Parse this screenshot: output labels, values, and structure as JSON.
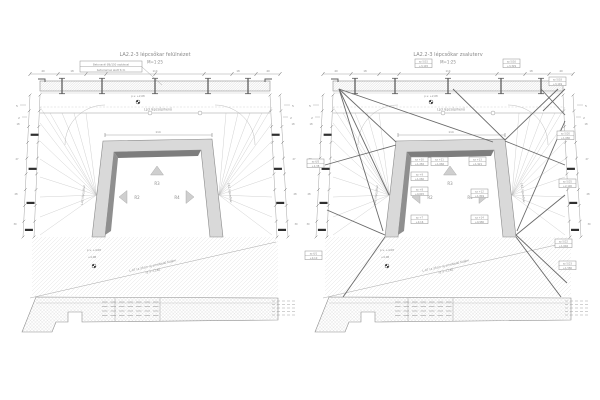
{
  "colors": {
    "background": "#ffffff",
    "line": "#9b9b9b",
    "thin_line": "#bdbdbd",
    "dark_line": "#5e5e5e",
    "text": "#8a8a8a",
    "frame_fill": "#d9d9d9",
    "frame_shadow": "#7d7d7d",
    "arrow_fill": "#cfcfcf",
    "hatch": "#d6d6d6",
    "tie_bar": "#2f2f2f"
  },
  "panels": [
    {
      "title": "LA2.2-3 lépcsőkar felülnézet",
      "scale": "M=1:25",
      "note_line1": "Betonacél Ø6/150 osztással",
      "note_line2": "betonlemez alatt 5cm",
      "landing_label": "Lp3 lépcsőpihenő",
      "benchmark_top": "p.v. +2,08",
      "benchmark_left_line1": "p.v. +4,08",
      "benchmark_left_line2": "+4,08",
      "slab_note_line1": "L-07 (a 25cm-ig emelkedő födém",
      "slab_note_line2": "sz = +2,80",
      "arrow_up_label": "R3",
      "arrow_left_label": "R2",
      "arrow_right_label": "R4",
      "side_label_left": "LA2 lépcsőkar",
      "side_label_right": "LA2 lépcsőkar",
      "top_dims": [
        "40",
        "18",
        "114",
        "18",
        "40"
      ],
      "frame_dim": "114",
      "side_dims": [
        "18",
        "27",
        "28",
        "30"
      ],
      "tick_labels": [
        "5",
        "2"
      ]
    },
    {
      "title": "LA2.2-3 lépcsőkar zsaluterv",
      "scale": "M=1:25",
      "landing_label": "Lp3 lépcsőpihenő",
      "benchmark_top": "p.v. +2,08",
      "benchmark_left_line1": "p.v. +4,08",
      "benchmark_left_line2": "+4,08",
      "slab_note_line1": "L-07 (a 25cm-ig emelkedő födém",
      "slab_note_line2": "sz = +2,80",
      "arrow_up_label": "R3",
      "arrow_left_label": "R2",
      "arrow_right_label": "R4",
      "side_label_left": "LA2 lépcsőkar",
      "side_label_right": "LA2 lépcsőkar",
      "top_dims": [
        "40",
        "18",
        "114",
        "18",
        "40"
      ],
      "frame_dim": "114",
      "side_dims": [
        "18",
        "27",
        "28",
        "30"
      ],
      "tick_labels": [
        "5",
        "2"
      ],
      "tags": [
        {
          "l1": "sz 5/15",
          "l2": "+3,145"
        },
        {
          "l1": "sz 5/16",
          "l2": "+3,329"
        },
        {
          "l1": "sz 5/18",
          "l2": "+3,149"
        },
        {
          "l1": "sz 5/20",
          "l2": "+1,680"
        },
        {
          "l1": "sz 5/25",
          "l2": "+2,190"
        },
        {
          "l1": "sz 5/22",
          "l2": "+1,646"
        },
        {
          "l1": "sz 5/23",
          "l2": "+1,580"
        },
        {
          "l1": "sz 6/5",
          "l2": "+1,38"
        },
        {
          "l1": "sz 6/1",
          "l2": "+0,10"
        },
        {
          "l1": "sz +10",
          "l2": "+1,282"
        },
        {
          "l1": "sz +11",
          "l2": "+1,666"
        },
        {
          "l1": "sz +9",
          "l2": "+1,060"
        },
        {
          "l1": "sz +8",
          "l2": "+0,645"
        },
        {
          "l1": "sz +7",
          "l2": "+0,16"
        },
        {
          "l1": "sz +13",
          "l2": "+1,921"
        },
        {
          "l1": "sz +12",
          "l2": "+1,849"
        },
        {
          "l1": "sz +14",
          "l2": "+0,980"
        }
      ]
    }
  ]
}
